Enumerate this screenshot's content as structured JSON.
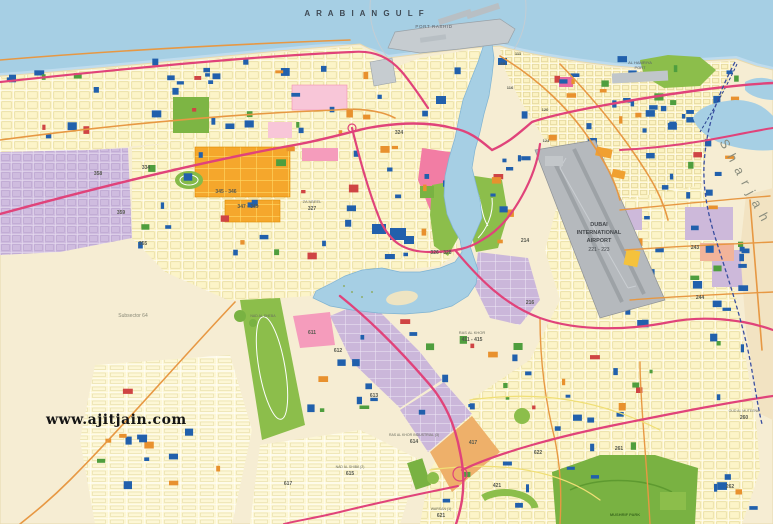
{
  "map": {
    "title": "Dubai city street map",
    "watermark": "www.ajitjain.com",
    "colors": {
      "sea": "#a6cfe4",
      "sea_shallow": "#bfdcee",
      "desert": "#f8efd9",
      "urban": "#fbf3c6",
      "road_major": "#e0437a",
      "road_secondary": "#e79843",
      "road_minor": "#f0df76",
      "park_green": "#7db544",
      "industrial_purple": "#cbb7da",
      "residential_purple": "#cfbcdf",
      "orange_zone": "#f5a72c",
      "pink_zone": "#f290b2",
      "airport_gray": "#b5b9bd",
      "building_blue": "#2160ac",
      "border_blue": "#3a4fa0",
      "sharjah_band": "#f2e3c2"
    },
    "labels": [
      {
        "t": "A R A B I A N   G U L F",
        "x": 365,
        "y": 16,
        "s": 8,
        "c": "#3f4a55",
        "sp": 2,
        "w": "bold"
      },
      {
        "t": "PORT RASHID",
        "x": 434,
        "y": 28,
        "s": 4.5,
        "c": "#5a6068",
        "sp": 0.6
      },
      {
        "t": "AL HAMRIYA",
        "x": 640,
        "y": 64,
        "s": 4,
        "c": "#5a6068"
      },
      {
        "t": "PORT",
        "x": 640,
        "y": 69,
        "s": 4,
        "c": "#5a6068"
      },
      {
        "t": "S h a r j a h",
        "x": 741,
        "y": 183,
        "s": 13,
        "c": "#8a8d7e",
        "r": 62,
        "sp": 2,
        "f": "serif"
      },
      {
        "t": "DUBAI",
        "x": 599,
        "y": 226,
        "s": 5.5,
        "c": "#44484c",
        "w": "bold"
      },
      {
        "t": "INTERNATIONAL",
        "x": 599,
        "y": 234,
        "s": 5.5,
        "c": "#44484c",
        "w": "bold"
      },
      {
        "t": "AIRPORT",
        "x": 599,
        "y": 242,
        "s": 5.5,
        "c": "#44484c",
        "w": "bold"
      },
      {
        "t": "221 - 223",
        "x": 599,
        "y": 251,
        "s": 5,
        "c": "#44484c"
      },
      {
        "t": "Subsector 64",
        "x": 133,
        "y": 317,
        "s": 5,
        "c": "#8a8a78"
      },
      {
        "t": "358",
        "x": 98,
        "y": 175,
        "s": 5,
        "c": "#55584e",
        "w": "bold"
      },
      {
        "t": "359",
        "x": 121,
        "y": 214,
        "s": 5,
        "c": "#55584e",
        "w": "bold"
      },
      {
        "t": "355",
        "x": 143,
        "y": 245,
        "s": 5,
        "c": "#55584e",
        "w": "bold"
      },
      {
        "t": "334",
        "x": 146,
        "y": 169,
        "s": 5,
        "c": "#55584e",
        "w": "bold"
      },
      {
        "t": "345 - 346",
        "x": 226,
        "y": 193,
        "s": 5,
        "c": "#55584e",
        "w": "bold"
      },
      {
        "t": "347 - 349",
        "x": 248,
        "y": 208,
        "s": 5,
        "c": "#55584e",
        "w": "bold"
      },
      {
        "t": "ZA'ABEEL",
        "x": 312,
        "y": 203,
        "s": 4,
        "c": "#6a6d5e"
      },
      {
        "t": "327",
        "x": 312,
        "y": 210,
        "s": 5,
        "c": "#55584e",
        "w": "bold"
      },
      {
        "t": "324",
        "x": 399,
        "y": 134,
        "s": 5,
        "c": "#55584e",
        "w": "bold"
      },
      {
        "t": "326 - 328",
        "x": 441,
        "y": 254,
        "s": 5,
        "c": "#55584e",
        "w": "bold"
      },
      {
        "t": "RAS AL KHOR",
        "x": 472,
        "y": 334,
        "s": 4,
        "c": "#6a6d5e"
      },
      {
        "t": "411 - 415",
        "x": 472,
        "y": 341,
        "s": 5,
        "c": "#55584e",
        "w": "bold"
      },
      {
        "t": "611",
        "x": 312,
        "y": 334,
        "s": 5,
        "c": "#55584e",
        "w": "bold"
      },
      {
        "t": "612",
        "x": 338,
        "y": 352,
        "s": 5,
        "c": "#55584e",
        "w": "bold"
      },
      {
        "t": "613",
        "x": 374,
        "y": 397,
        "s": 5,
        "c": "#55584e",
        "w": "bold"
      },
      {
        "t": "RAS AL KHOR INDUSTRIAL (3)",
        "x": 414,
        "y": 436,
        "s": 3.5,
        "c": "#6a6d5e"
      },
      {
        "t": "614",
        "x": 414,
        "y": 443,
        "s": 5,
        "c": "#55584e",
        "w": "bold"
      },
      {
        "t": "NAD AL SHIBA (2)",
        "x": 350,
        "y": 468,
        "s": 3.5,
        "c": "#6a6d5e"
      },
      {
        "t": "615",
        "x": 350,
        "y": 475,
        "s": 5,
        "c": "#55584e",
        "w": "bold"
      },
      {
        "t": "617",
        "x": 288,
        "y": 485,
        "s": 5,
        "c": "#55584e",
        "w": "bold"
      },
      {
        "t": "WARSAN (1)",
        "x": 441,
        "y": 510,
        "s": 3.5,
        "c": "#6a6d5e"
      },
      {
        "t": "621",
        "x": 441,
        "y": 517,
        "s": 5,
        "c": "#55584e",
        "w": "bold"
      },
      {
        "t": "417",
        "x": 473,
        "y": 444,
        "s": 5,
        "c": "#55584e",
        "w": "bold"
      },
      {
        "t": "421",
        "x": 497,
        "y": 487,
        "s": 5,
        "c": "#55584e",
        "w": "bold"
      },
      {
        "t": "622",
        "x": 538,
        "y": 454,
        "s": 5,
        "c": "#55584e",
        "w": "bold"
      },
      {
        "t": "261",
        "x": 619,
        "y": 450,
        "s": 5,
        "c": "#55584e",
        "w": "bold"
      },
      {
        "t": "262",
        "x": 730,
        "y": 488,
        "s": 5,
        "c": "#55584e",
        "w": "bold"
      },
      {
        "t": "OUD AL MUTEENA",
        "x": 744,
        "y": 412,
        "s": 3.5,
        "c": "#6a6d5e"
      },
      {
        "t": "260",
        "x": 744,
        "y": 419,
        "s": 5,
        "c": "#55584e",
        "w": "bold"
      },
      {
        "t": "MUSHRIF PARK",
        "x": 625,
        "y": 516,
        "s": 4,
        "c": "#3c6b1f",
        "w": "bold"
      },
      {
        "t": "NAD AL SHEBA",
        "x": 263,
        "y": 317,
        "s": 3.5,
        "c": "#6a6d5e"
      },
      {
        "t": "214",
        "x": 525,
        "y": 242,
        "s": 5,
        "c": "#55584e",
        "w": "bold"
      },
      {
        "t": "216",
        "x": 530,
        "y": 304,
        "s": 5,
        "c": "#55584e",
        "w": "bold"
      },
      {
        "t": "243",
        "x": 695,
        "y": 249,
        "s": 5,
        "c": "#55584e",
        "w": "bold"
      },
      {
        "t": "244",
        "x": 700,
        "y": 299,
        "s": 5,
        "c": "#55584e",
        "w": "bold"
      },
      {
        "t": "111",
        "x": 518,
        "y": 55,
        "s": 4,
        "c": "#55584e",
        "w": "bold"
      },
      {
        "t": "115",
        "x": 502,
        "y": 65,
        "s": 4,
        "c": "#55584e",
        "w": "bold"
      },
      {
        "t": "116",
        "x": 510,
        "y": 89,
        "s": 4,
        "c": "#55584e",
        "w": "bold"
      },
      {
        "t": "120",
        "x": 545,
        "y": 111,
        "s": 4,
        "c": "#55584e",
        "w": "bold"
      },
      {
        "t": "124",
        "x": 546,
        "y": 142,
        "s": 4,
        "c": "#55584e",
        "w": "bold"
      }
    ]
  }
}
